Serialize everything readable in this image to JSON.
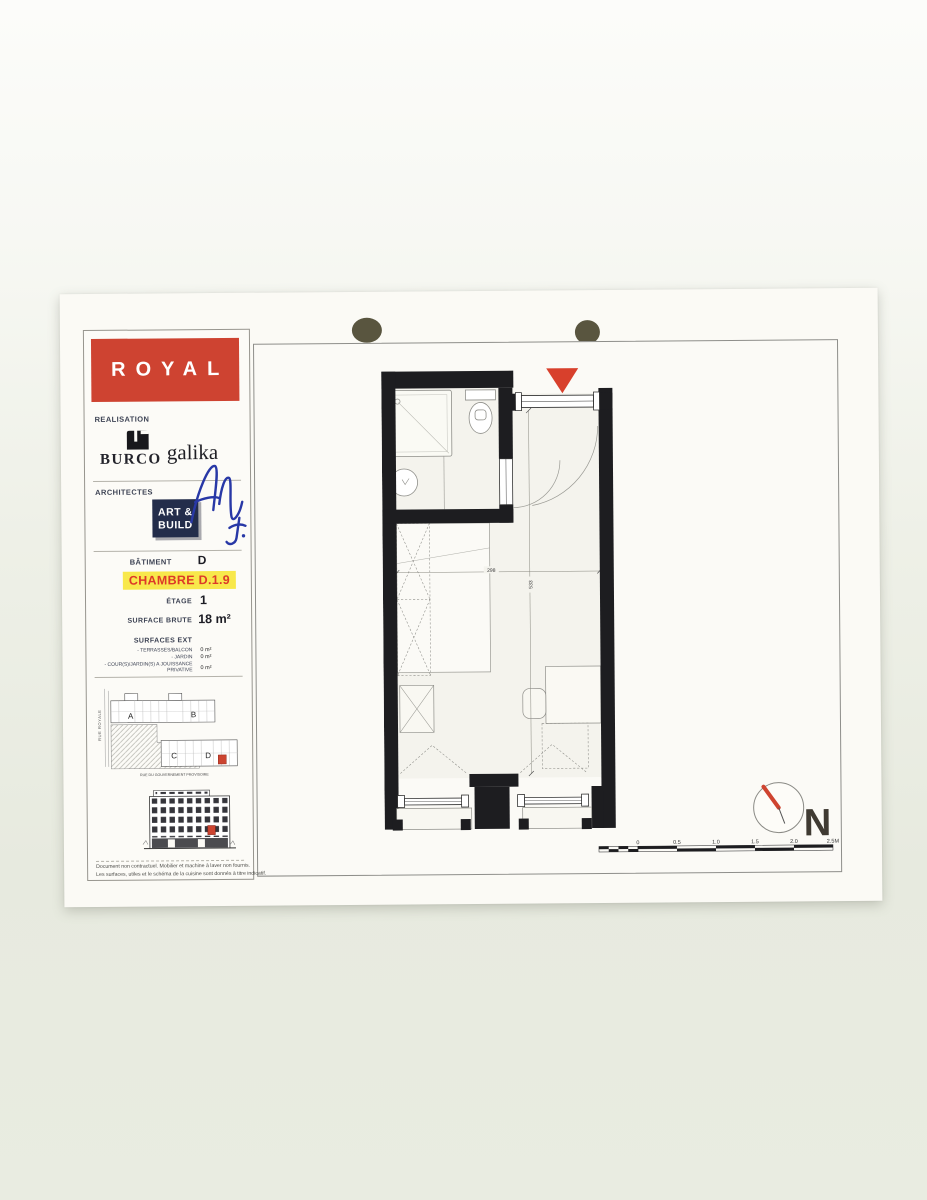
{
  "sheet": {
    "project_name": "ROYAL",
    "realisation": {
      "label": "REALISATION",
      "firm1": "BURCO",
      "firm2": "galika"
    },
    "architectes": {
      "label": "ARCHITECTES",
      "firm_line1": "ART &",
      "firm_line2": "BUILD"
    },
    "batiment": {
      "label": "BÂTIMENT",
      "value": "D"
    },
    "unit": {
      "label": "CHAMBRE D.1.9"
    },
    "etage": {
      "label": "ÉTAGE",
      "value": "1"
    },
    "surface_brute": {
      "label": "SURFACE BRUTE",
      "value": "18 m²"
    },
    "surfaces_ext": {
      "label": "SURFACES EXT",
      "items": [
        {
          "label": "- TERRASSES/BALCON",
          "value": "0 m²"
        },
        {
          "label": "- JARDIN",
          "value": "0 m²"
        },
        {
          "label": "- COUR(S)/JARDIN(S) A JOUISSANCE PRIVATIVE",
          "value": "0 m²"
        }
      ]
    },
    "site_plan": {
      "street_left": "RUE ROYALE",
      "street_bottom": "RUE DU GOUVERNEMENT PROVISOIRE",
      "building_a": "A",
      "building_b": "B",
      "building_c": "C",
      "building_d": "D"
    },
    "disclaimer_line1": "Document non contractuel. Mobilier et machine à laver non fournis.",
    "disclaimer_line2": "Les surfaces, utiles et le schéma de la cuisine sont donnés à titre indicatif."
  },
  "plan": {
    "dim_width": "298",
    "dim_height": "533"
  },
  "north": {
    "label": "N"
  },
  "scale_bar": {
    "labels": [
      "0",
      "0.5",
      "1.0",
      "1.5",
      "2.0",
      "2.5M"
    ]
  },
  "colors": {
    "royal_red": "#ce4331",
    "highlight_yellow": "#f8e84b",
    "unit_text_red": "#dd3a28",
    "signature_blue": "#2838a6",
    "artbuild_navy": "#232d4b",
    "marker_red": "#d8402c",
    "wall_black": "#1d1d20"
  }
}
